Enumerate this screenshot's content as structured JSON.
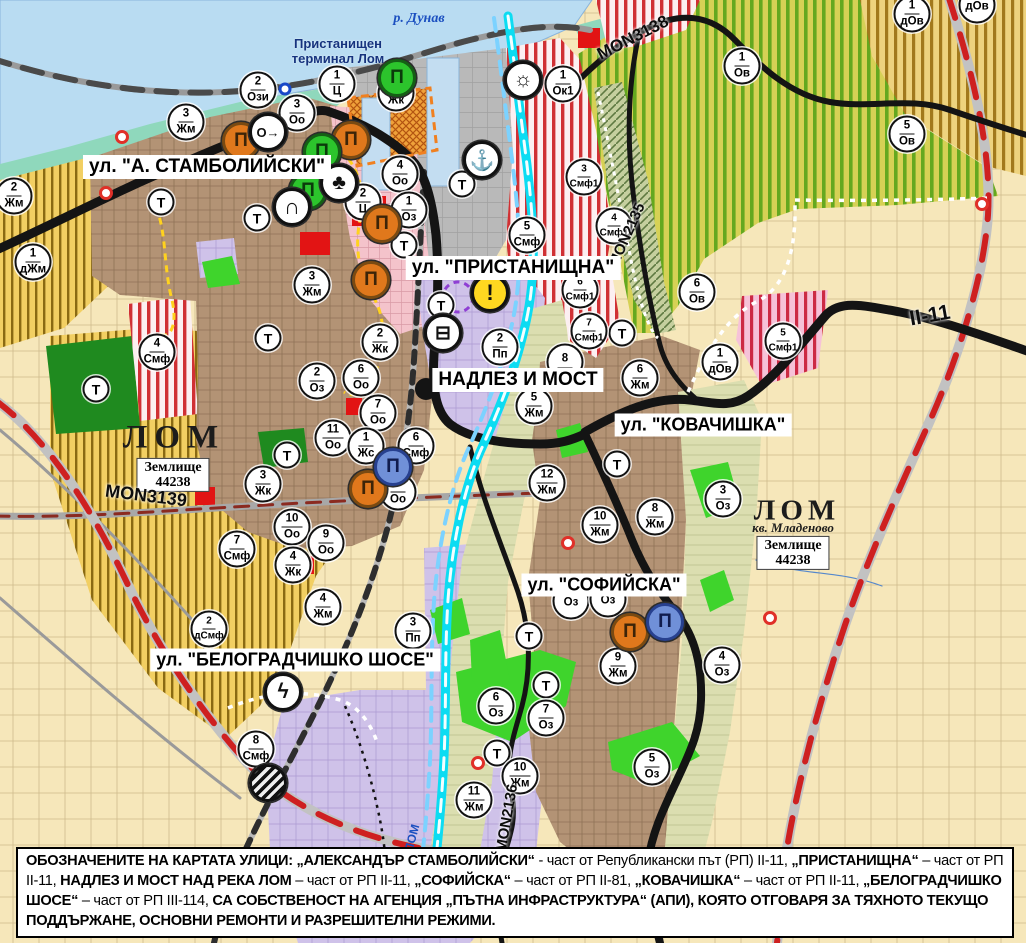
{
  "title": "Устройствена карта – град Лом",
  "palette": {
    "water": "#b9dcf2",
    "shore-teal": "#8fd8bc",
    "port-gray": "#b9b9b9",
    "zone-yellow": "#f2cf62",
    "zone-yellow-stripe": "#8a6a12",
    "vineyard": "#d6d155",
    "vineyard-stripe": "#64a81f",
    "urban-brown": "#b39375",
    "fields-beige": "#f6e7ba",
    "lavender": "#cfc2e9",
    "olive": "#dbdeb0",
    "pink": "#f4c3cb",
    "red-stripe": "#d03034",
    "bright-green": "#3fd42c",
    "dark-green": "#1f8a1f",
    "pale-green": "#cfe67c",
    "road-black": "#141414",
    "road-red-dash": "#ce2020",
    "river-cyan": "#0cdcf2",
    "rail-gray": "#4a4a4a",
    "red-patch": "#e21414",
    "orange-zone": "#efa13a",
    "marker-orange": "#e0781c",
    "marker-green": "#2cc42c",
    "marker-blue": "#7090d8",
    "warning-yellow": "#ffd820"
  },
  "street_labels": [
    {
      "name": "street-label-stamboliyski",
      "text": "ул. \"А. СТАМБОЛИЙСКИ\"",
      "x": 207,
      "y": 167,
      "fs": 19
    },
    {
      "name": "street-label-pristanishtna",
      "text": "ул. \"ПРИСТАНИЩНА\"",
      "x": 513,
      "y": 268,
      "fs": 19
    },
    {
      "name": "street-label-nadlez-i-most",
      "text": "НАДЛЕЗ И МОСТ",
      "x": 518,
      "y": 380,
      "fs": 19
    },
    {
      "name": "street-label-kovachishka",
      "text": "ул. \"КОВАЧИШКА\"",
      "x": 703,
      "y": 425,
      "fs": 18
    },
    {
      "name": "street-label-sofiyska",
      "text": "ул. \"СОФИЙСКА\"",
      "x": 604,
      "y": 585,
      "fs": 18
    },
    {
      "name": "street-label-belogradchishko-shose",
      "text": "ул. \"БЕЛОГРАДЧИШКО ШОСЕ\"",
      "x": 295,
      "y": 660,
      "fs": 18
    }
  ],
  "place_labels": [
    {
      "name": "river-danube-label",
      "cls": "river-name",
      "text": "р. Дунав",
      "x": 419,
      "y": 19
    },
    {
      "name": "port-terminal-label",
      "cls": "port-name",
      "text": "Пристанищен\nтерминал Лом",
      "x": 338,
      "y": 52
    },
    {
      "name": "city-label-lom-west",
      "cls": "city-label",
      "text": "ЛОМ",
      "x": 174,
      "y": 438,
      "fs": 33,
      "ls": 7
    },
    {
      "name": "landplot-label-west",
      "cls": "zem-box",
      "text": "Землище\n44238",
      "x": 173,
      "y": 475
    },
    {
      "name": "city-label-lom-mladenovo",
      "cls": "city-label",
      "text": "ЛОМ",
      "x": 797,
      "y": 511,
      "fs": 29,
      "ls": 5
    },
    {
      "name": "kvartal-mladenovo-label",
      "cls": "kvartal",
      "text": "кв. Младеново",
      "x": 793,
      "y": 528
    },
    {
      "name": "landplot-label-east",
      "cls": "zem-box",
      "text": "Землище\n44238",
      "x": 793,
      "y": 553
    },
    {
      "name": "river-lom-label",
      "cls": "river-lom",
      "text": "ЛОМ",
      "x": 412,
      "y": 838,
      "rot": -75
    }
  ],
  "road_labels": [
    {
      "name": "road-label-mon3138",
      "text": "MON3138",
      "x": 633,
      "y": 38,
      "rot": -27,
      "fs": 17
    },
    {
      "name": "road-label-mon2135",
      "text": "MON2135",
      "x": 627,
      "y": 235,
      "rot": -66,
      "fs": 15
    },
    {
      "name": "road-label-mon3139",
      "text": "MON3139",
      "x": 146,
      "y": 496,
      "rot": 7,
      "fs": 18
    },
    {
      "name": "road-label-mon2136",
      "text": "MON2136",
      "x": 507,
      "y": 818,
      "rot": -80,
      "fs": 15
    },
    {
      "name": "road-label-ii-11",
      "text": "II-11",
      "x": 930,
      "y": 316,
      "rot": -10,
      "fs": 21
    }
  ],
  "zone_markers": [
    {
      "n": "2",
      "z": "Жм",
      "x": 14,
      "y": 196
    },
    {
      "n": "1",
      "z": "дЖм",
      "x": 33,
      "y": 262
    },
    {
      "n": "3",
      "z": "Жм",
      "x": 186,
      "y": 122
    },
    {
      "n": "2",
      "z": "Ози",
      "x": 258,
      "y": 90
    },
    {
      "n": "1",
      "z": "Ц",
      "x": 337,
      "y": 84
    },
    {
      "n": "1",
      "z": "Жк",
      "x": 396,
      "y": 93
    },
    {
      "n": "3",
      "z": "Оо",
      "x": 297,
      "y": 113
    },
    {
      "n": "4",
      "z": "Оо",
      "x": 400,
      "y": 174
    },
    {
      "n": "2",
      "z": "Ц",
      "x": 363,
      "y": 202
    },
    {
      "n": "1",
      "z": "Оз",
      "x": 409,
      "y": 210
    },
    {
      "n": "3",
      "z": "Жм",
      "x": 312,
      "y": 285
    },
    {
      "n": "1",
      "z": "Ок1",
      "x": 563,
      "y": 84
    },
    {
      "n": "3",
      "z": "Смф1",
      "x": 584,
      "y": 177
    },
    {
      "n": "4",
      "z": "Смф1",
      "x": 614,
      "y": 226
    },
    {
      "n": "5",
      "z": "Смф",
      "x": 527,
      "y": 235
    },
    {
      "n": "1",
      "z": "Ов",
      "x": 742,
      "y": 66
    },
    {
      "n": "1",
      "z": "дОв",
      "x": 912,
      "y": 14
    },
    {
      "n": "",
      "z": "дОв",
      "x": 977,
      "y": 5
    },
    {
      "n": "5",
      "z": "Ов",
      "x": 907,
      "y": 134
    },
    {
      "n": "6",
      "z": "Ов",
      "x": 697,
      "y": 292
    },
    {
      "n": "1",
      "z": "дОв",
      "x": 720,
      "y": 362
    },
    {
      "n": "5",
      "z": "Смф1",
      "x": 783,
      "y": 341
    },
    {
      "n": "6",
      "z": "Смф1",
      "x": 580,
      "y": 290
    },
    {
      "n": "7",
      "z": "Смф1",
      "x": 589,
      "y": 331
    },
    {
      "n": "8",
      "z": "",
      "x": 565,
      "y": 362
    },
    {
      "n": "6",
      "z": "Жм",
      "x": 640,
      "y": 378
    },
    {
      "n": "5",
      "z": "Жм",
      "x": 534,
      "y": 406
    },
    {
      "n": "12",
      "z": "Жм",
      "x": 547,
      "y": 483
    },
    {
      "n": "10",
      "z": "Жм",
      "x": 600,
      "y": 525
    },
    {
      "n": "8",
      "z": "Жм",
      "x": 655,
      "y": 517
    },
    {
      "n": "3",
      "z": "Оз",
      "x": 723,
      "y": 499
    },
    {
      "n": "2",
      "z": "Пп",
      "x": 500,
      "y": 347
    },
    {
      "n": "2",
      "z": "Оз",
      "x": 317,
      "y": 381
    },
    {
      "n": "11",
      "z": "Оо",
      "x": 333,
      "y": 438
    },
    {
      "n": "3",
      "z": "Жк",
      "x": 263,
      "y": 484
    },
    {
      "n": "10",
      "z": "Оо",
      "x": 292,
      "y": 527
    },
    {
      "n": "9",
      "z": "Оо",
      "x": 326,
      "y": 543
    },
    {
      "n": "7",
      "z": "Смф",
      "x": 237,
      "y": 549
    },
    {
      "n": "4",
      "z": "Жк",
      "x": 293,
      "y": 565
    },
    {
      "n": "4",
      "z": "Смф",
      "x": 157,
      "y": 352
    },
    {
      "n": "2",
      "z": "Жк",
      "x": 380,
      "y": 342
    },
    {
      "n": "6",
      "z": "Оо",
      "x": 361,
      "y": 378
    },
    {
      "n": "7",
      "z": "Оо",
      "x": 378,
      "y": 413
    },
    {
      "n": "1",
      "z": "Жс",
      "x": 366,
      "y": 446
    },
    {
      "n": "6",
      "z": "Смф",
      "x": 416,
      "y": 446
    },
    {
      "n": "8",
      "z": "Оо",
      "x": 398,
      "y": 492
    },
    {
      "n": "2",
      "z": "дСмф",
      "x": 209,
      "y": 629
    },
    {
      "n": "4",
      "z": "Жм",
      "x": 323,
      "y": 607
    },
    {
      "n": "3",
      "z": "Пп",
      "x": 413,
      "y": 631
    },
    {
      "n": "8",
      "z": "Смф",
      "x": 256,
      "y": 749
    },
    {
      "n": "",
      "z": "Оз",
      "x": 571,
      "y": 601
    },
    {
      "n": "",
      "z": "Оз",
      "x": 608,
      "y": 599
    },
    {
      "n": "9",
      "z": "Жм",
      "x": 618,
      "y": 666
    },
    {
      "n": "4",
      "z": "Оз",
      "x": 722,
      "y": 665
    },
    {
      "n": "6",
      "z": "Оз",
      "x": 496,
      "y": 706
    },
    {
      "n": "7",
      "z": "Оз",
      "x": 546,
      "y": 718
    },
    {
      "n": "5",
      "z": "Оз",
      "x": 652,
      "y": 767
    },
    {
      "n": "10",
      "z": "Жм",
      "x": 520,
      "y": 776
    },
    {
      "n": "11",
      "z": "Жм",
      "x": 474,
      "y": 800
    }
  ],
  "t_markers": [
    {
      "x": 161,
      "y": 202
    },
    {
      "x": 257,
      "y": 218
    },
    {
      "x": 404,
      "y": 245
    },
    {
      "x": 462,
      "y": 184
    },
    {
      "x": 441,
      "y": 305
    },
    {
      "x": 268,
      "y": 338
    },
    {
      "x": 96,
      "y": 389
    },
    {
      "x": 287,
      "y": 455
    },
    {
      "x": 622,
      "y": 333
    },
    {
      "x": 617,
      "y": 464
    },
    {
      "x": 529,
      "y": 636
    },
    {
      "x": 546,
      "y": 685
    },
    {
      "x": 497,
      "y": 753
    }
  ],
  "icon_markers": [
    {
      "name": "monument-icon",
      "glyph": "Π",
      "x": 241,
      "y": 141,
      "bg": "#e0781c",
      "fg": "#3c2408",
      "bd": "#7a4a12"
    },
    {
      "name": "monument-icon",
      "glyph": "Π",
      "x": 351,
      "y": 140,
      "bg": "#e0781c",
      "fg": "#3c2408",
      "bd": "#7a4a12"
    },
    {
      "name": "monument-icon",
      "glyph": "Π",
      "x": 382,
      "y": 224,
      "bg": "#e0781c",
      "fg": "#3c2408",
      "bd": "#7a4a12"
    },
    {
      "name": "monument-icon",
      "glyph": "Π",
      "x": 371,
      "y": 280,
      "bg": "#e0781c",
      "fg": "#3c2408",
      "bd": "#7a4a12"
    },
    {
      "name": "monument-icon",
      "glyph": "Π",
      "x": 368,
      "y": 489,
      "bg": "#e0781c",
      "fg": "#3c2408",
      "bd": "#7a4a12"
    },
    {
      "name": "monument-icon",
      "glyph": "Π",
      "x": 630,
      "y": 632,
      "bg": "#e0781c",
      "fg": "#3c2408",
      "bd": "#7a4a12"
    },
    {
      "name": "monument-icon-green",
      "glyph": "Π",
      "x": 397,
      "y": 78,
      "bg": "#2cc42c",
      "fg": "#0b3a0b",
      "bd": "#156015"
    },
    {
      "name": "monument-icon-green",
      "glyph": "Π",
      "x": 322,
      "y": 152,
      "bg": "#2cc42c",
      "fg": "#0b3a0b",
      "bd": "#156015"
    },
    {
      "name": "monument-icon-green",
      "glyph": "Π",
      "x": 308,
      "y": 191,
      "bg": "#2cc42c",
      "fg": "#0b3a0b",
      "bd": "#156015"
    },
    {
      "name": "monument-icon-blue",
      "glyph": "Π",
      "x": 393,
      "y": 467,
      "bg": "#7090d8",
      "fg": "#101c4e",
      "bd": "#27408f"
    },
    {
      "name": "monument-icon-blue",
      "glyph": "Π",
      "x": 665,
      "y": 622,
      "bg": "#7090d8",
      "fg": "#101c4e",
      "bd": "#27408f"
    },
    {
      "name": "key-arrow-icon",
      "glyph": "O→",
      "x": 268,
      "y": 132,
      "bg": "#ffffff",
      "fg": "#111111",
      "bd": "#111111",
      "size": 13
    },
    {
      "name": "club-icon",
      "glyph": "♣",
      "x": 339,
      "y": 183,
      "bg": "#ffffff",
      "fg": "#111111",
      "bd": "#111111",
      "size": 21
    },
    {
      "name": "tunnel-icon",
      "glyph": "∩",
      "x": 292,
      "y": 207,
      "bg": "#ffffff",
      "fg": "#111111",
      "bd": "#111111",
      "size": 22
    },
    {
      "name": "anchor-icon",
      "glyph": "⚓",
      "x": 482,
      "y": 160,
      "bg": "#ffffff",
      "fg": "#111111",
      "bd": "#111111",
      "size": 20
    },
    {
      "name": "port-terminal-icon",
      "glyph": "☼",
      "x": 523,
      "y": 80,
      "bg": "#ffffff",
      "fg": "#111111",
      "bd": "#111111",
      "size": 21
    },
    {
      "name": "bus-icon",
      "glyph": "⊟",
      "x": 443,
      "y": 333,
      "bg": "#ffffff",
      "fg": "#111111",
      "bd": "#111111",
      "size": 19
    },
    {
      "name": "warning-icon",
      "glyph": "!",
      "x": 490,
      "y": 293,
      "bg": "#ffd820",
      "fg": "#111111",
      "bd": "#111111",
      "size": 22
    },
    {
      "name": "power-icon",
      "glyph": "ϟ",
      "x": 283,
      "y": 692,
      "bg": "#ffffff",
      "fg": "#111111",
      "bd": "#111111",
      "size": 21
    },
    {
      "name": "rail-crossing-icon",
      "glyph": "",
      "x": 268,
      "y": 783,
      "bg": "striped",
      "fg": "#ffffff",
      "bd": "#111111"
    },
    {
      "name": "blue-ring-icon",
      "glyph": "",
      "x": 285,
      "y": 89,
      "bg": "#ffffff",
      "fg": "#1848c8",
      "bd": "#1848c8",
      "dia": 13
    }
  ],
  "ring_markers": [
    {
      "x": 122,
      "y": 137
    },
    {
      "x": 106,
      "y": 193
    },
    {
      "x": 568,
      "y": 543
    },
    {
      "x": 478,
      "y": 763
    },
    {
      "x": 770,
      "y": 618
    },
    {
      "x": 982,
      "y": 204
    }
  ],
  "footer": {
    "segments": [
      {
        "text": "ОБОЗНАЧЕНИТЕ НА КАРТАТА УЛИЦИ: „АЛЕКСАНДЪР СТАМБОЛИЙСКИ“",
        "bold": true
      },
      {
        "text": " - част от Републикански път (РП) II-11, ",
        "bold": false
      },
      {
        "text": "„ПРИСТАНИЩНА“",
        "bold": true
      },
      {
        "text": " – част от РП II-11, ",
        "bold": false
      },
      {
        "text": "НАДЛЕЗ И МОСТ НАД РЕКА ЛОМ",
        "bold": true
      },
      {
        "text": " – част от РП II-11, ",
        "bold": false
      },
      {
        "text": "„СОФИЙСКА“",
        "bold": true
      },
      {
        "text": " – част от РП II-81, ",
        "bold": false
      },
      {
        "text": "„КОВАЧИШКА“",
        "bold": true
      },
      {
        "text": " – част от РП II-11, ",
        "bold": false
      },
      {
        "text": "„БЕЛОГРАДЧИШКО ШОСЕ“",
        "bold": true
      },
      {
        "text": " – част от РП III-114, ",
        "bold": false
      },
      {
        "text": "СА СОБСТВЕНОСТ НА АГЕНЦИЯ „ПЪТНА ИНФРАСТРУКТУРА“ (АПИ), КОЯТО ОТГОВАРЯ ЗА ТЯХНОТО ТЕКУЩО ПОДДЪРЖАНЕ, ОСНОВНИ РЕМОНТИ И РАЗРЕШИТЕЛНИ РЕЖИМИ.",
        "bold": true
      }
    ]
  }
}
